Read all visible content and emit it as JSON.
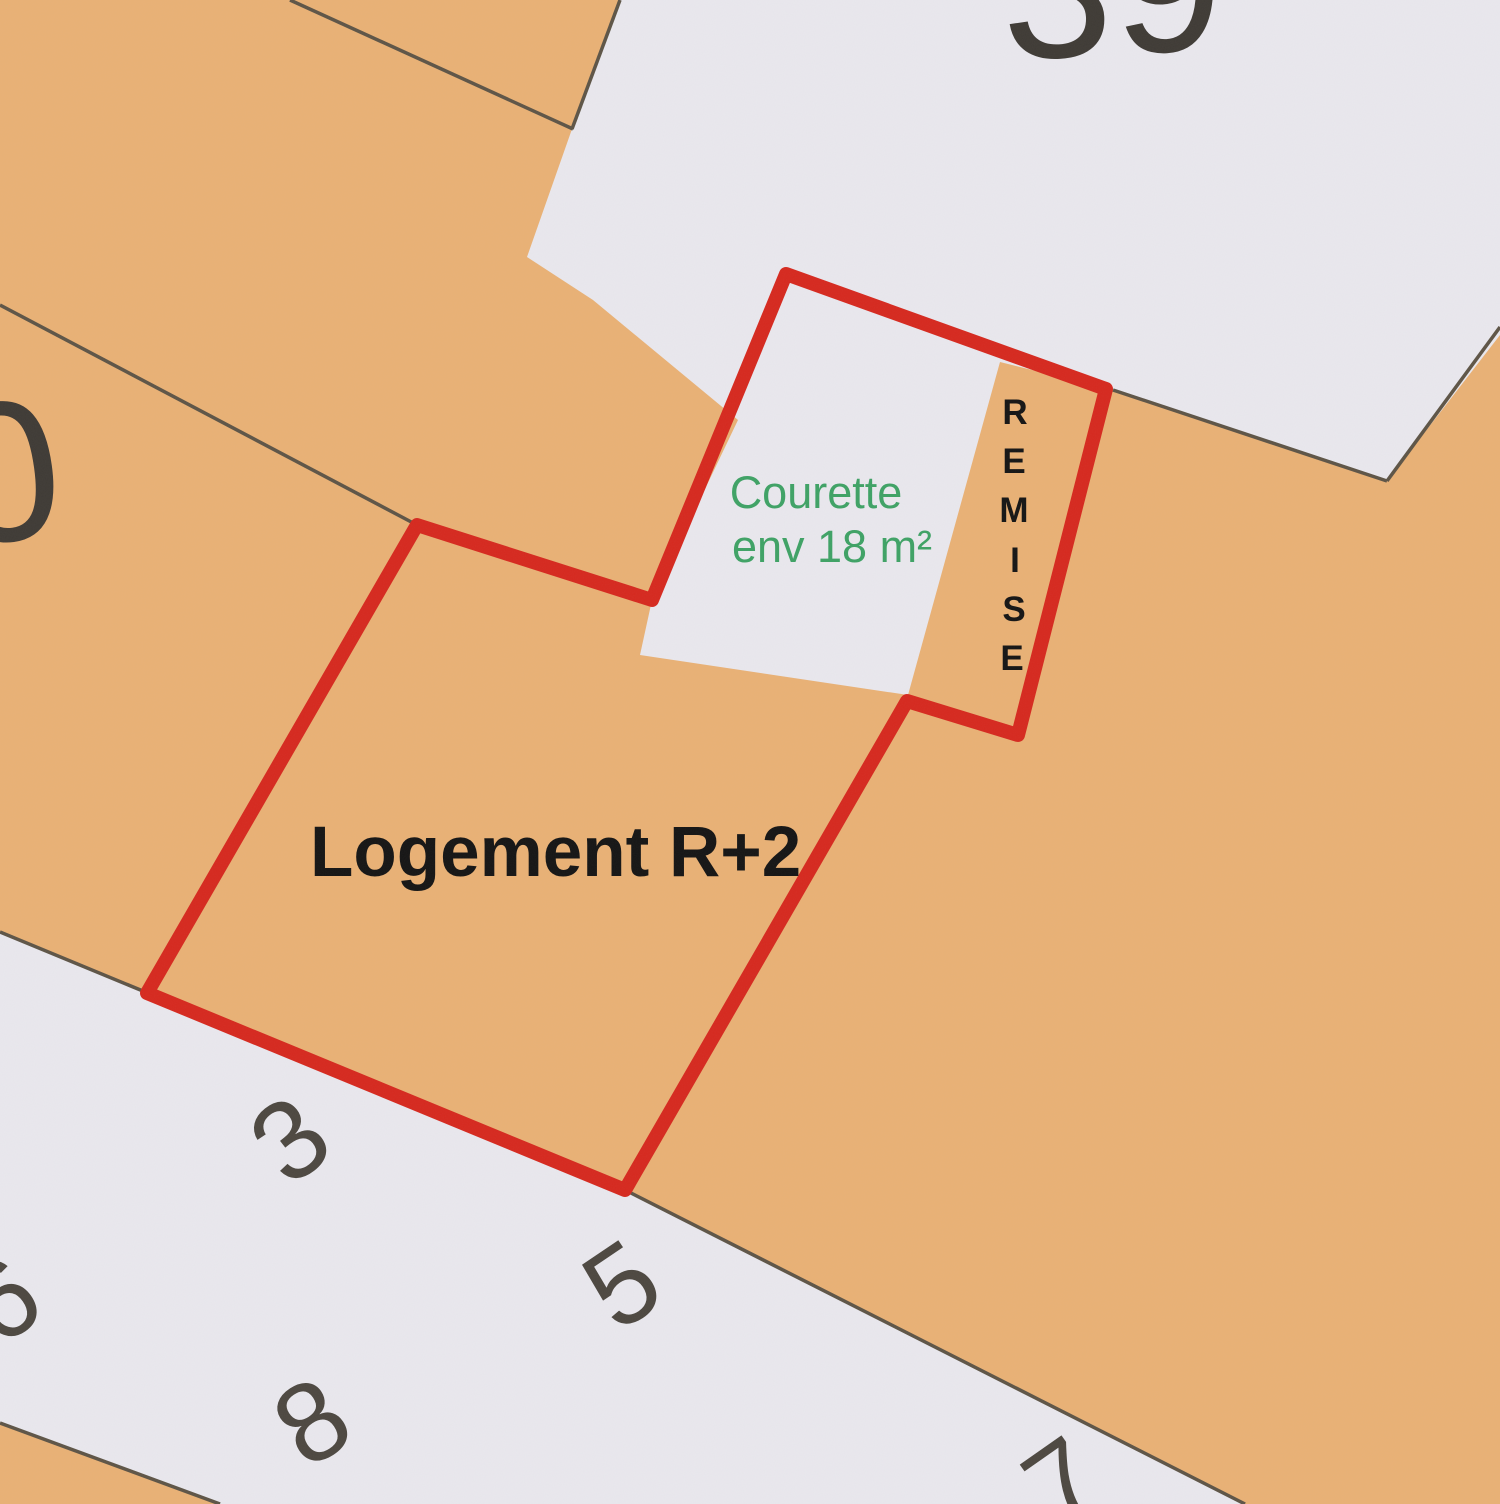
{
  "map": {
    "type": "cadastral-plan",
    "colors": {
      "parcel_fill": "#e9b175",
      "street_fill": "#e9e8ee",
      "boundary_line": "#5d5446",
      "property_outline": "#d6281e",
      "courtyard_label": "#3ea265",
      "dwelling_label": "#141414",
      "remise_label": "#141414",
      "street_number": "#4c4740",
      "parcel_number": "#3e3a35"
    },
    "labels": {
      "dwelling": "Logement R+2",
      "courtyard_line1": "Courette",
      "courtyard_line2": "env 18 m²",
      "remise": "REMISE",
      "remise_letters": [
        "R",
        "E",
        "M",
        "I",
        "S",
        "E"
      ]
    },
    "parcel_numbers": {
      "north": "39",
      "west_partial": "0"
    },
    "street_numbers": {
      "n6_partial": "6",
      "n3": "3",
      "n5": "5",
      "n8": "8",
      "n7_partial": "7"
    }
  }
}
